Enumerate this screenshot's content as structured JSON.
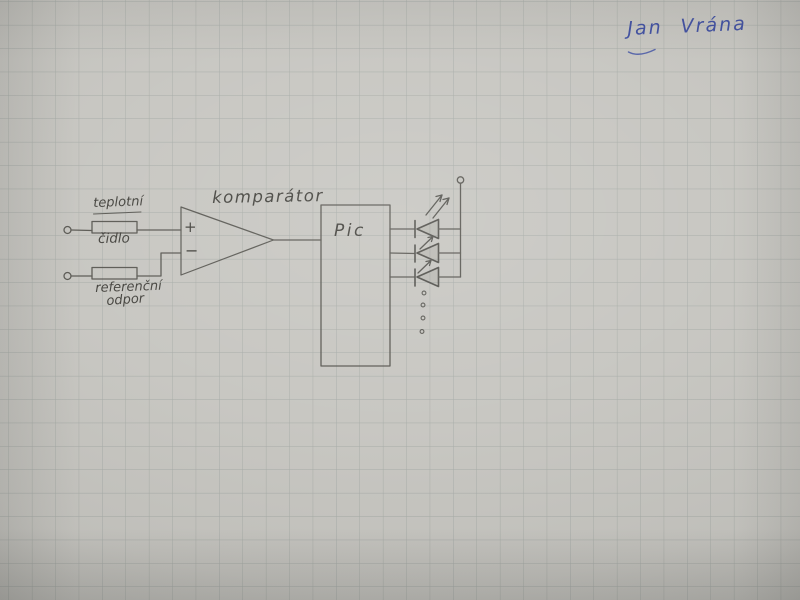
{
  "photo": {
    "paper_color": "#c7c6c1",
    "grid_color": "#9aa19d",
    "pencil_color": "#4f4e49",
    "ink_color": "#4050a2"
  },
  "signature": "Jan Vrána",
  "schematic": {
    "temp_sensor": {
      "line1": "teplotní",
      "line2": "čidlo"
    },
    "reference_resistor": {
      "line1": "referenční",
      "line2": "odpor"
    },
    "comparator": {
      "label": "komparátor",
      "plus": "+",
      "minus": "−"
    },
    "mcu": {
      "label": "Pic"
    }
  }
}
